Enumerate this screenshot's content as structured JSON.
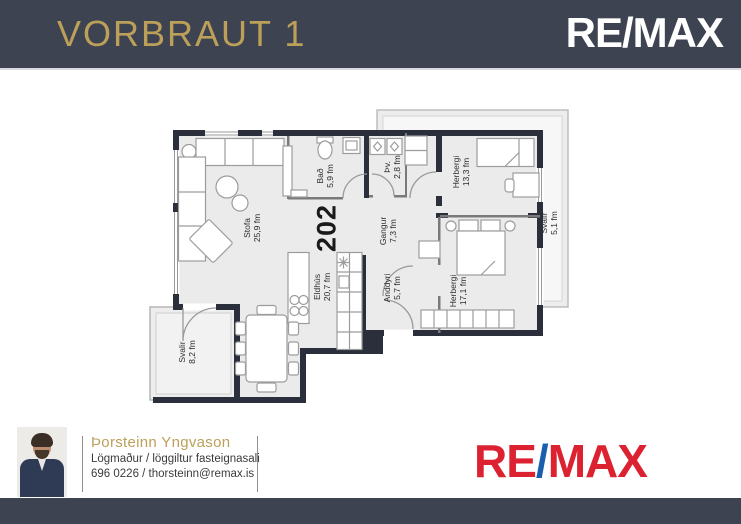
{
  "header": {
    "title": "VORBRAUT 1"
  },
  "brand": {
    "re": "RE",
    "slash": "/",
    "max": "MAX"
  },
  "unit": {
    "number": "202"
  },
  "rooms": {
    "stofa": {
      "name": "Stofa",
      "area": "25,9 fm"
    },
    "bad": {
      "name": "Bað",
      "area": "5,9 fm"
    },
    "tv": {
      "name": "Þv.",
      "area": "2,8 fm"
    },
    "gangur": {
      "name": "Gangur",
      "area": "7,3 fm"
    },
    "eldhus": {
      "name": "Eldhús",
      "area": "20,7 fm"
    },
    "anddyri": {
      "name": "Anddyri",
      "area": "5,7 fm"
    },
    "herbergi1": {
      "name": "Herbergi",
      "area": "13,3 fm"
    },
    "herbergi2": {
      "name": "Herbergi",
      "area": "17,1 fm"
    },
    "svalir1": {
      "name": "Svalir",
      "area": "5,1 fm"
    },
    "svalir2": {
      "name": "Svalir",
      "area": "8,2 fm"
    }
  },
  "agent": {
    "name": "Þorsteinn Yngvason",
    "role": "Lögmaður / löggiltur fasteignasali",
    "contact": "696 0226 / thorsteinn@remax.is"
  },
  "colors": {
    "header_bg": "#3E4351",
    "gold": "#BCA05A",
    "remax_red": "#DC2231",
    "remax_blue": "#1B5EAB",
    "wall": "#2A2F3B",
    "room_fill": "#EBEBEB"
  }
}
